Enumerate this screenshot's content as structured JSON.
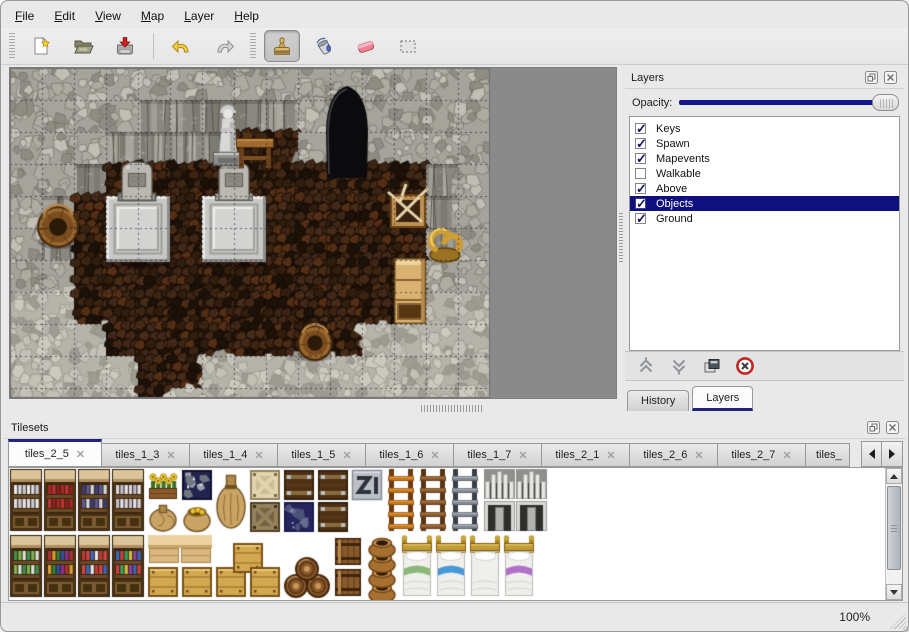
{
  "menu": {
    "items": [
      "File",
      "Edit",
      "View",
      "Map",
      "Layer",
      "Help"
    ]
  },
  "toolbar": {
    "items": [
      {
        "kind": "grip"
      },
      {
        "kind": "button",
        "name": "new-map",
        "icon": "new-file-icon"
      },
      {
        "kind": "button",
        "name": "open-map",
        "icon": "open-folder-icon"
      },
      {
        "kind": "button",
        "name": "save-map",
        "icon": "save-icon"
      },
      {
        "kind": "separator"
      },
      {
        "kind": "button",
        "name": "undo",
        "icon": "undo-icon"
      },
      {
        "kind": "button",
        "name": "redo",
        "icon": "redo-icon"
      },
      {
        "kind": "grip"
      },
      {
        "kind": "button",
        "name": "stamp-tool",
        "icon": "stamp-tool-icon",
        "selected": true
      },
      {
        "kind": "button",
        "name": "fill-tool",
        "icon": "fill-tool-icon"
      },
      {
        "kind": "button",
        "name": "eraser-tool",
        "icon": "eraser-tool-icon"
      },
      {
        "kind": "button",
        "name": "select-tool",
        "icon": "select-tool-icon"
      }
    ]
  },
  "layers_panel": {
    "title": "Layers",
    "opacity_label": "Opacity:",
    "opacity_value": 1.0,
    "layers": [
      {
        "label": "Keys",
        "checked": true,
        "selected": false
      },
      {
        "label": "Spawn",
        "checked": true,
        "selected": false
      },
      {
        "label": "Mapevents",
        "checked": true,
        "selected": false
      },
      {
        "label": "Walkable",
        "checked": false,
        "selected": false
      },
      {
        "label": "Above",
        "checked": true,
        "selected": false
      },
      {
        "label": "Objects",
        "checked": true,
        "selected": true
      },
      {
        "label": "Ground",
        "checked": true,
        "selected": false
      }
    ],
    "buttons": [
      "move-up",
      "move-down",
      "duplicate",
      "delete"
    ],
    "dock_tabs": [
      {
        "label": "History",
        "active": false
      },
      {
        "label": "Layers",
        "active": true
      }
    ]
  },
  "tilesets_panel": {
    "title": "Tilesets",
    "tab_close_glyph": "✕",
    "tabs": [
      {
        "label": "tiles_2_5",
        "active": true
      },
      {
        "label": "tiles_1_3"
      },
      {
        "label": "tiles_1_4"
      },
      {
        "label": "tiles_1_5"
      },
      {
        "label": "tiles_1_6"
      },
      {
        "label": "tiles_1_7"
      },
      {
        "label": "tiles_2_1"
      },
      {
        "label": "tiles_2_6"
      },
      {
        "label": "tiles_2_7"
      },
      {
        "label": "tiles_",
        "clipped": true
      }
    ]
  },
  "statusbar": {
    "zoom": "100%"
  },
  "colors": {
    "accent_navy": "#16168c",
    "selection_navy": "#0f0f7d",
    "tab_accent": "#23237c",
    "map_background": "#8a8a8a",
    "delete_red": "#c22525"
  },
  "map_view": {
    "tile_size": 32,
    "width_px": 480,
    "height_px": 330,
    "outside_color": "#8a8a8a",
    "legend": {
      "W": "rock-wall",
      "V": "rock-face",
      "F": "dark-floor",
      "L": "light-rock-floor"
    },
    "rows": [
      "WWWWWWWWWWWWWWW",
      "WWWWVVVVVWWWWWW",
      "WWWVVVVFFWWWWWW",
      "WWVFFFFFFFFFFVW",
      "WVFFFFFFFFFFFVW",
      "WVFFFFFFFFFFFVW",
      "WWFFFFFFFFFFFWW",
      "LLFFFFFFFFFFFLL",
      "LLLFFFFFFFFLLLL",
      "LLLLFFLLLLLLLLL",
      "LLLLFLLLLLLLLLL"
    ],
    "objects": [
      {
        "type": "doorway",
        "x": 314,
        "y": 16,
        "w": 46,
        "h": 94
      },
      {
        "type": "platform",
        "x": 96,
        "y": 128,
        "w": 64,
        "h": 66
      },
      {
        "type": "platform",
        "x": 192,
        "y": 128,
        "w": 64,
        "h": 66
      },
      {
        "type": "gravestone",
        "x": 112,
        "y": 94,
        "w": 30,
        "h": 38
      },
      {
        "type": "gravestone",
        "x": 209,
        "y": 94,
        "w": 30,
        "h": 38
      },
      {
        "type": "statue",
        "x": 198,
        "y": 26,
        "w": 40,
        "h": 74
      },
      {
        "type": "table",
        "x": 226,
        "y": 62,
        "w": 38,
        "h": 40
      },
      {
        "type": "basket",
        "x": 28,
        "y": 138,
        "w": 40,
        "h": 42
      },
      {
        "type": "basket",
        "x": 288,
        "y": 258,
        "w": 34,
        "h": 34
      },
      {
        "type": "crate_broken",
        "x": 380,
        "y": 122,
        "w": 36,
        "h": 38
      },
      {
        "type": "horn",
        "x": 416,
        "y": 154,
        "w": 38,
        "h": 42
      },
      {
        "type": "shelf",
        "x": 384,
        "y": 190,
        "w": 32,
        "h": 66
      }
    ]
  },
  "tileset_view": {
    "tiles": [
      {
        "type": "shelf_tall",
        "x": 1,
        "y": 1,
        "variant": "dishes"
      },
      {
        "type": "shelf_tall",
        "x": 35,
        "y": 1,
        "variant": "redware"
      },
      {
        "type": "shelf_tall",
        "x": 69,
        "y": 1,
        "variant": "blueware"
      },
      {
        "type": "shelf_tall",
        "x": 103,
        "y": 1,
        "variant": "jars"
      },
      {
        "type": "flowerbox",
        "x": 139,
        "y": 2
      },
      {
        "type": "ore_crate",
        "x": 173,
        "y": 2
      },
      {
        "type": "sack",
        "x": 139,
        "y": 34
      },
      {
        "type": "sack_gold",
        "x": 173,
        "y": 34
      },
      {
        "type": "sack_tall",
        "x": 207,
        "y": 1
      },
      {
        "type": "crate_x",
        "x": 241,
        "y": 2,
        "variant": "light"
      },
      {
        "type": "crate_x",
        "x": 241,
        "y": 34,
        "variant": "dark"
      },
      {
        "type": "crate_strap",
        "x": 275,
        "y": 2
      },
      {
        "type": "ore_tile",
        "x": 275,
        "y": 34
      },
      {
        "type": "crate_strap",
        "x": 309,
        "y": 2
      },
      {
        "type": "crate_strap",
        "x": 309,
        "y": 34
      },
      {
        "type": "metal_tile",
        "x": 343,
        "y": 2
      },
      {
        "type": "ladder",
        "x": 379,
        "y": 1,
        "variant": "orange"
      },
      {
        "type": "ladder",
        "x": 411,
        "y": 1,
        "variant": "brown"
      },
      {
        "type": "ladder",
        "x": 443,
        "y": 1,
        "variant": "iron"
      },
      {
        "type": "arch",
        "x": 475,
        "y": 1
      },
      {
        "type": "arch",
        "x": 507,
        "y": 1
      },
      {
        "type": "shelf_tall",
        "x": 1,
        "y": 67,
        "variant": "greens"
      },
      {
        "type": "shelf_tall",
        "x": 35,
        "y": 67,
        "variant": "books"
      },
      {
        "type": "shelf_tall",
        "x": 69,
        "y": 67,
        "variant": "bottles"
      },
      {
        "type": "shelf_tall",
        "x": 103,
        "y": 67,
        "variant": "potions"
      },
      {
        "type": "counter",
        "x": 139,
        "y": 67
      },
      {
        "type": "counter",
        "x": 171,
        "y": 67
      },
      {
        "type": "crate_tan",
        "x": 139,
        "y": 99
      },
      {
        "type": "crate_tan",
        "x": 173,
        "y": 99
      },
      {
        "type": "crate_tan",
        "x": 207,
        "y": 99
      },
      {
        "type": "crate_tan",
        "x": 224,
        "y": 75
      },
      {
        "type": "crate_tan",
        "x": 241,
        "y": 99
      },
      {
        "type": "barrel_pyramid",
        "x": 276,
        "y": 90
      },
      {
        "type": "barrel_stack",
        "x": 324,
        "y": 67
      },
      {
        "type": "pot_stack",
        "x": 358,
        "y": 67
      },
      {
        "type": "bed",
        "x": 392,
        "y": 67,
        "variant": "green"
      },
      {
        "type": "bed",
        "x": 426,
        "y": 67,
        "variant": "blue"
      },
      {
        "type": "bed",
        "x": 460,
        "y": 67,
        "variant": "white"
      },
      {
        "type": "bed",
        "x": 494,
        "y": 67,
        "variant": "purple"
      }
    ]
  }
}
